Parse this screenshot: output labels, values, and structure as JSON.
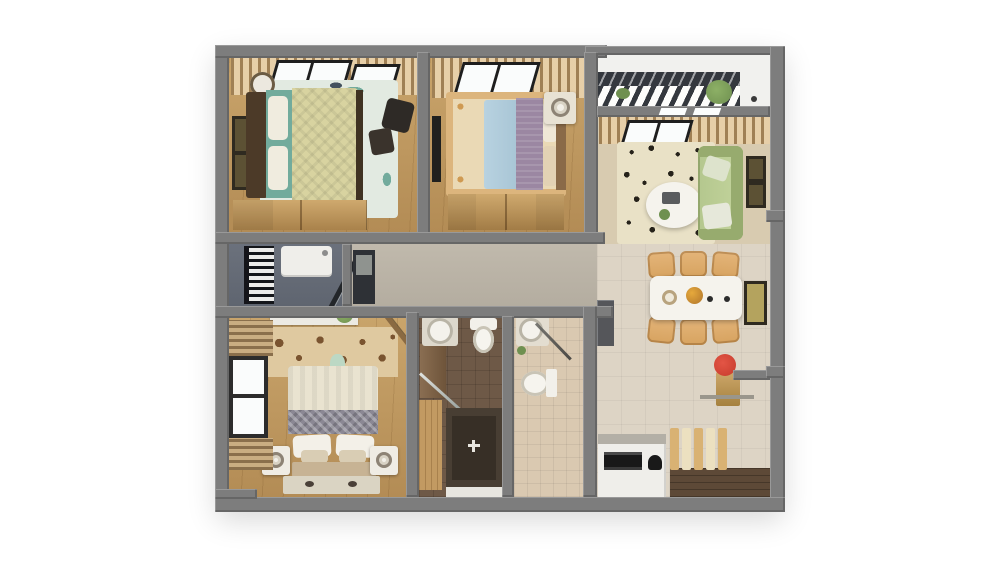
{
  "image_type": "3d-apartment-floor-plan-render",
  "visible_text": [],
  "palette": {
    "bg": "#ffffff",
    "wall": "#7d7d7d",
    "dark": "#34383e",
    "wood": "#c9a46b",
    "woodDark": "#b38c55",
    "woodDeep": "#8a6a42",
    "slate": "#5f6570",
    "corridor": "#b4ada0",
    "tile": "#ddd4c5",
    "tileLight": "#d8cbb0",
    "darkWood": "#5d4937",
    "bath1Floor": "#6e5947",
    "bath2Floor": "#dac9b1",
    "glass": "#fafcfc",
    "curtain": "#c8ab7e",
    "frame": "#2f2a20",
    "tealRug": "#e2eae1",
    "tealFish": "#72ab9c",
    "quilt": "#d8d3a0",
    "headboard": "#4c3a28",
    "bedBlue": "#a9c6d6",
    "bedMauve": "#9b87a2",
    "rugOrnate": "#ead9b5",
    "rugOrnateAccent": "#cf9a52",
    "sofaGreen": "#b4c78e",
    "sofaGreenDark": "#97ab6e",
    "livingRug": "#e9e1c6",
    "leaf": "#26221a",
    "chairTan": "#d7a360",
    "tableWhite": "#f5f3ed",
    "bed3Cream": "#e9e3d0",
    "bed3Gray": "#8b8894",
    "floralBase": "#dfc9a0",
    "floralBrown": "#7a5430",
    "accentRed": "#c63b2c",
    "plantGreen": "#6f9050",
    "appliance": "#efeeea",
    "black": "#191919"
  },
  "semantics": {
    "rooms": [
      {
        "id": "bedroom-1",
        "position": "top-left",
        "furniture": [
          "double-bed",
          "fish-pattern-rug",
          "wardrobe-dresser",
          "desk-chair",
          "wall-frames",
          "window",
          "curtains"
        ]
      },
      {
        "id": "bedroom-2",
        "position": "top-center",
        "furniture": [
          "double-bed-blue-mauve",
          "ornate-rug",
          "wardrobe",
          "nightstand-lamp",
          "wall-tv",
          "window",
          "curtains"
        ]
      },
      {
        "id": "balcony",
        "position": "top-right",
        "furniture": [
          "pergola-slats",
          "plants"
        ]
      },
      {
        "id": "living-room",
        "position": "right",
        "furniture": [
          "green-sofa",
          "leaf-pattern-rug",
          "oval-coffee-table",
          "laptop",
          "wall-frames"
        ]
      },
      {
        "id": "dining-area",
        "position": "right",
        "furniture": [
          "white-dining-table",
          "six-chairs",
          "wall-art",
          "flower-console"
        ]
      },
      {
        "id": "utility-room",
        "position": "middle-left",
        "furniture": [
          "washing-machine",
          "drying-rack",
          "door-leaf"
        ]
      },
      {
        "id": "entry-corridor",
        "position": "middle",
        "furniture": [
          "shoe-cabinet"
        ]
      },
      {
        "id": "bedroom-3-master",
        "position": "bottom-left",
        "furniture": [
          "double-bed",
          "nightstands-lamps",
          "floral-accent-rug",
          "window",
          "blinds",
          "ac-ledge"
        ]
      },
      {
        "id": "bathroom-1",
        "position": "bottom-center",
        "furniture": [
          "round-sink",
          "toilet",
          "walk-in-shower",
          "glass-partition",
          "wood-closet"
        ]
      },
      {
        "id": "bathroom-2",
        "position": "bottom-center",
        "furniture": [
          "round-sink",
          "toilet",
          "glass-partition"
        ]
      },
      {
        "id": "kitchen-area",
        "position": "bottom-right",
        "furniture": [
          "white-counter",
          "black-appliance",
          "wood-slat-screen",
          "dark-wood-floor"
        ]
      }
    ]
  }
}
